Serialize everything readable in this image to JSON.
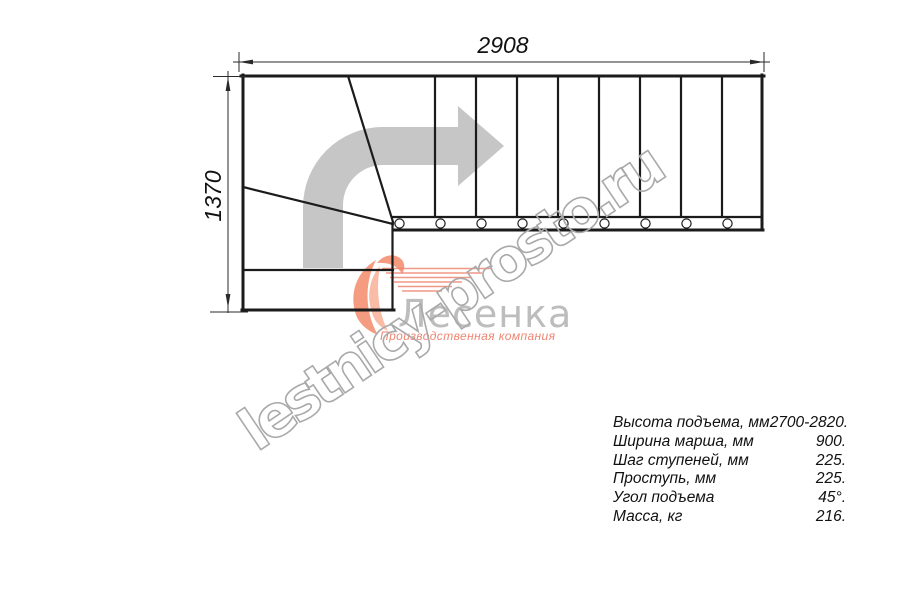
{
  "colors": {
    "line": "#1b1b1b",
    "arrow": "#c6c6c6",
    "wm": "#a9a9a9",
    "orange": "#f49b80",
    "orange-deep": "#ee8672",
    "graytext": "#bdbdbd"
  },
  "dimensions": {
    "width_mm": "2908",
    "depth_mm": "1370"
  },
  "plan": {
    "straight_treads": 9,
    "winder_steps": 3,
    "direction": "turn-right-then-straight"
  },
  "watermark": {
    "text": "lestnicy-prosto.ru"
  },
  "logo": {
    "name": "Лесенка",
    "tagline": "Производственная компания"
  },
  "specs": {
    "rows": [
      {
        "label": "Высота подъема, мм",
        "value": "2700-2820."
      },
      {
        "label": "Ширина марша, мм",
        "value": "900."
      },
      {
        "label": "Шаг ступеней, мм",
        "value": "225."
      },
      {
        "label": "Проступь, мм",
        "value": "225."
      },
      {
        "label": "Угол подъема",
        "value": "45°."
      },
      {
        "label": "Масса, кг",
        "value": "216."
      }
    ]
  }
}
